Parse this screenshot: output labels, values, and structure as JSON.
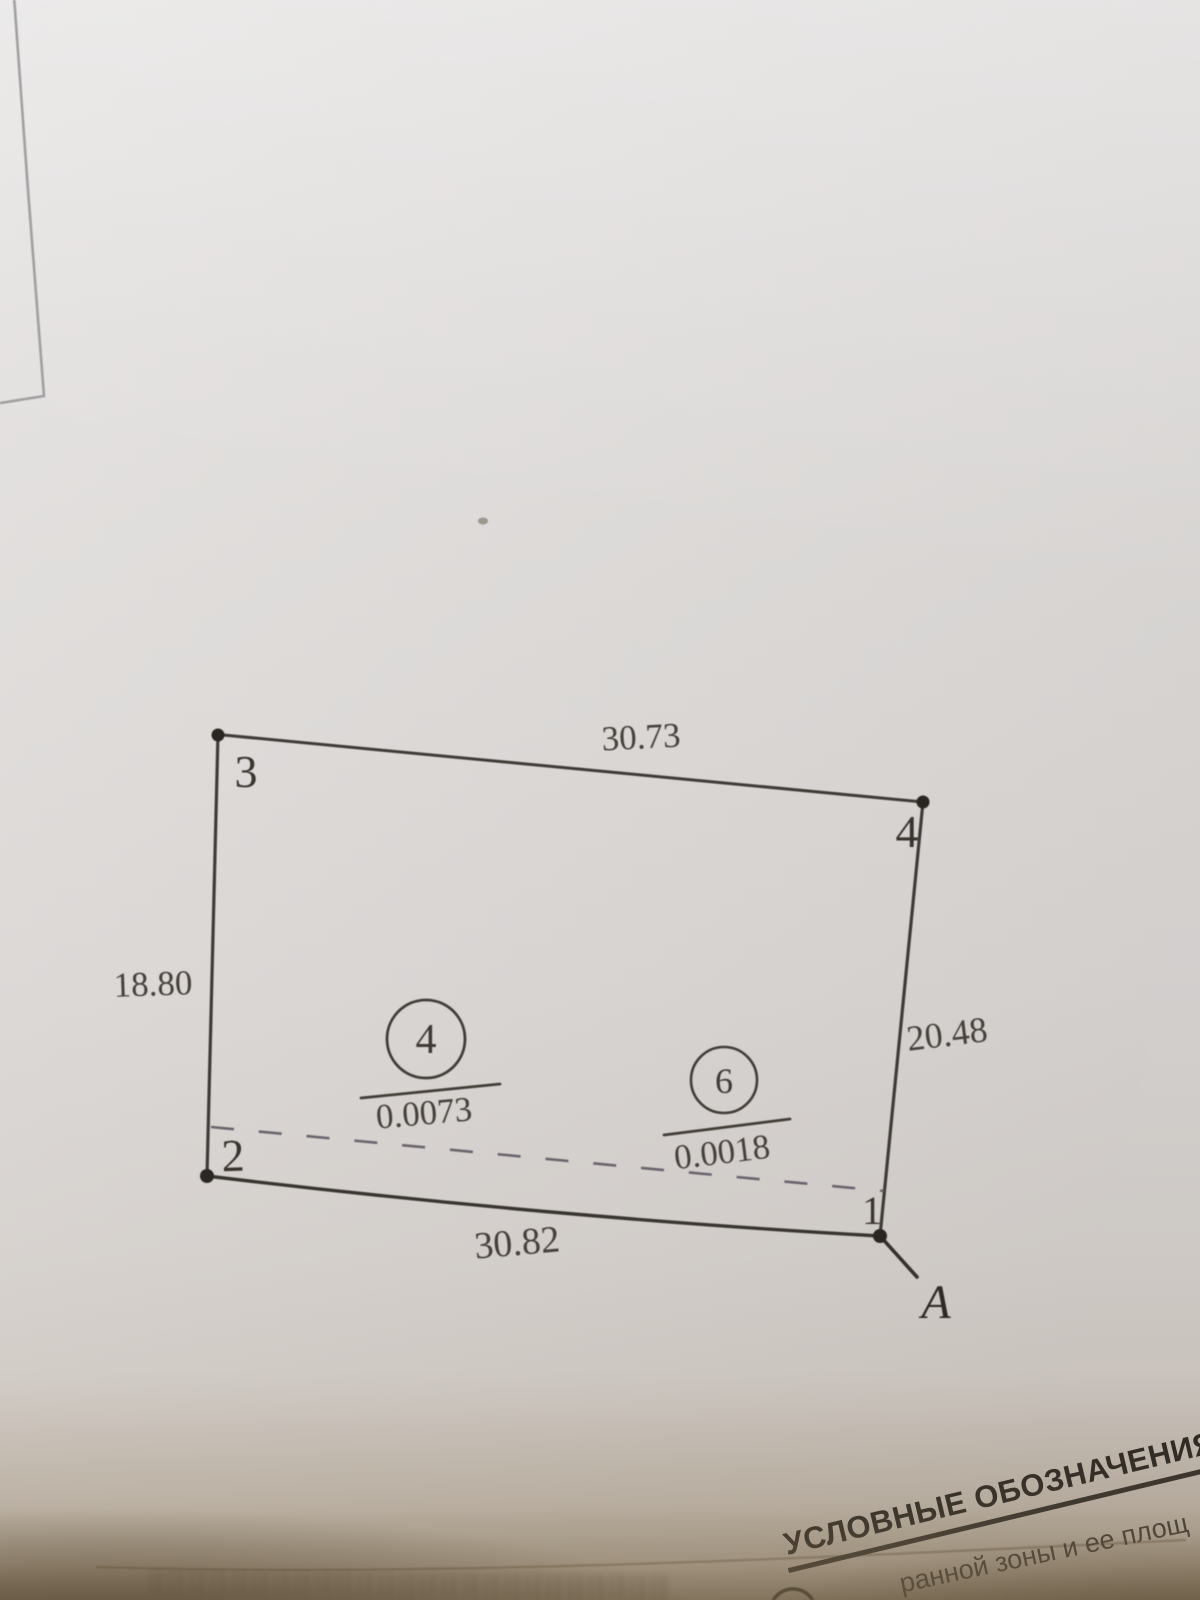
{
  "drawing": {
    "vertex_labels": {
      "v1": "1",
      "v2": "2",
      "v3": "3",
      "v4": "4"
    },
    "side_lengths": {
      "top": "30.73",
      "left": "18.80",
      "right": "20.48",
      "bottom": "30.82"
    },
    "parcels": [
      {
        "number": "4",
        "area": "0.0073"
      },
      {
        "number": "6",
        "area": "0.0018"
      }
    ],
    "point_label": "A"
  },
  "legend": {
    "title": "УСЛОВНЫЕ ОБОЗНАЧЕНИЯ",
    "entry_fragment": "ранной зоны и ее площ",
    "symbol_icon": "circle-outline-icon"
  },
  "colors": {
    "paper": "#dedbd9",
    "ink": "#3e3a35",
    "dashed_line": "#5f5862",
    "photo_shadow": "#8a7a5e"
  }
}
